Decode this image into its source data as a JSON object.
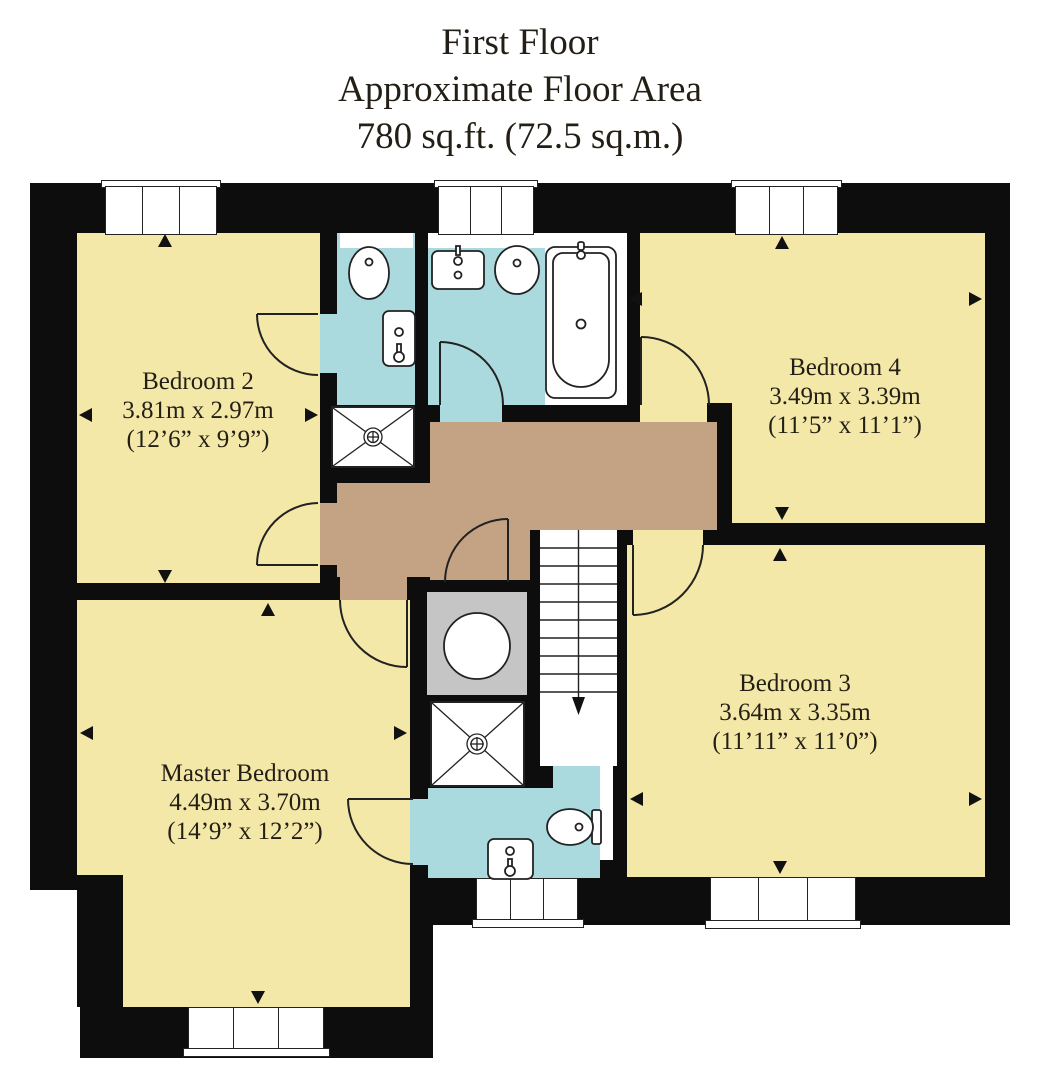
{
  "title": {
    "line1": "First Floor",
    "line2": "Approximate Floor Area",
    "line3": "780 sq.ft. (72.5 sq.m.)"
  },
  "rooms": {
    "bedroom2": {
      "name": "Bedroom 2",
      "metric": "3.81m x 2.97m",
      "imperial": "(12’6” x 9’9”)"
    },
    "bedroom4": {
      "name": "Bedroom 4",
      "metric": "3.49m x 3.39m",
      "imperial": "(11’5” x 11’1”)"
    },
    "bedroom3": {
      "name": "Bedroom 3",
      "metric": "3.64m x 3.35m",
      "imperial": "(11’11” x 11’0”)"
    },
    "master": {
      "name": "Master Bedroom",
      "metric": "4.49m x 3.70m",
      "imperial": "(14’9” x 12’2”)"
    }
  },
  "fixtures": [
    "toilet",
    "wash-basin",
    "shower-tray",
    "bath",
    "hot-water-cylinder",
    "staircase",
    "window",
    "door"
  ],
  "colors": {
    "room-yellow": "#f3e8a7",
    "bath-blue": "#abdade",
    "landing-brown": "#c4a284",
    "cupboard-gray": "#c5c5c5",
    "wall-black": "#0d0d0d",
    "line": "#222222",
    "text": "#241f16",
    "paper": "#ffffff"
  }
}
